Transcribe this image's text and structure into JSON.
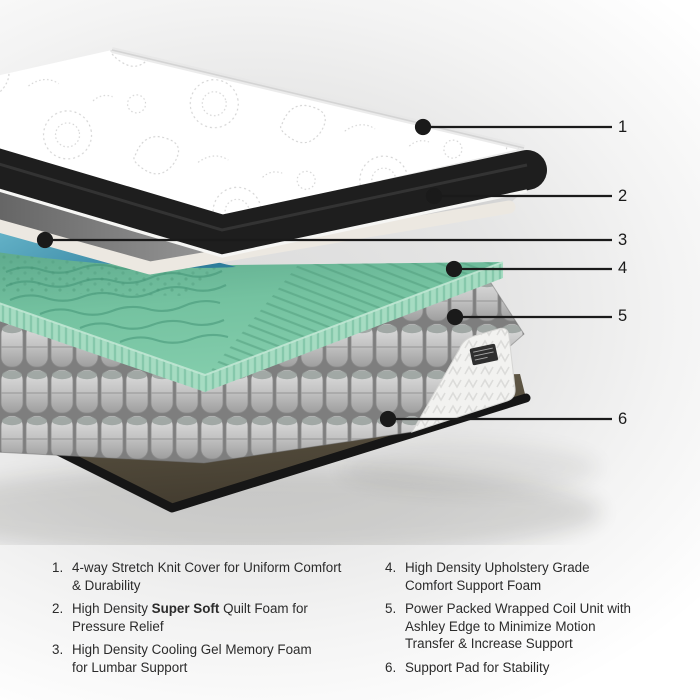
{
  "diagram": {
    "callouts": [
      {
        "label": "1"
      },
      {
        "label": "2"
      },
      {
        "label": "3"
      },
      {
        "label": "4"
      },
      {
        "label": "5"
      },
      {
        "label": "6"
      }
    ],
    "colors": {
      "cover_band": "#1d1d1d",
      "quilt_foam_edge": "#ece8e1",
      "cooling_gel_blue": "#4796b2",
      "memory_foam_green": "#74c2a0",
      "coil_gray": "#b4b4b4",
      "support_pad_brown": "#57503f"
    }
  },
  "legend": {
    "items": [
      {
        "num": "1.",
        "pre": "4-way Stretch Knit Cover for Uniform Comfort\n& Durability",
        "bold": "",
        "post": ""
      },
      {
        "num": "2.",
        "pre": "High Density ",
        "bold": "Super Soft",
        "post": " Quilt Foam for\nPressure Relief"
      },
      {
        "num": "3.",
        "pre": "High Density Cooling Gel Memory Foam\nfor Lumbar Support",
        "bold": "",
        "post": ""
      },
      {
        "num": "4.",
        "pre": "High Density Upholstery Grade\nComfort Support Foam",
        "bold": "",
        "post": ""
      },
      {
        "num": "5.",
        "pre": "Power Packed Wrapped Coil Unit with\nAshley Edge to Minimize Motion\nTransfer & Increase Support",
        "bold": "",
        "post": ""
      },
      {
        "num": "6.",
        "pre": "Support Pad for Stability",
        "bold": "",
        "post": ""
      }
    ]
  }
}
